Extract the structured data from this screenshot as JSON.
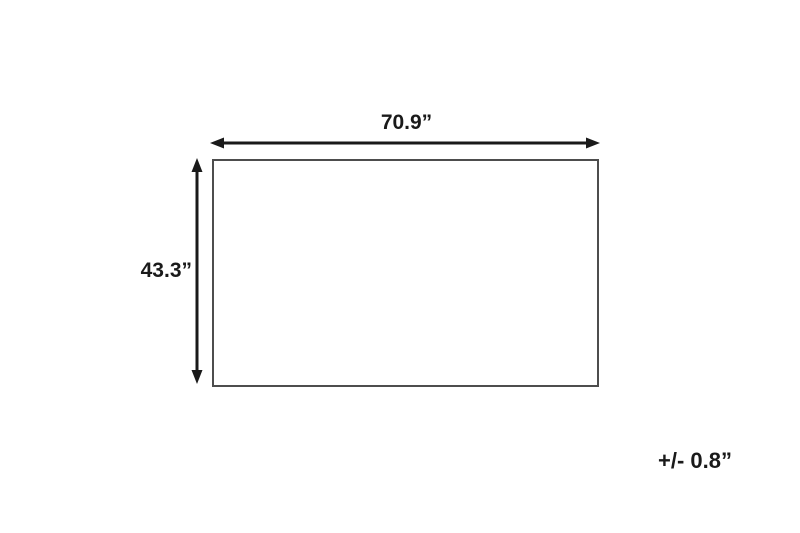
{
  "diagram": {
    "type": "product-dimension-diagram",
    "shape": "rectangle",
    "width_label": "70.9”",
    "height_label": "43.3”",
    "tolerance_label": "+/- 0.8”",
    "colors": {
      "background": "#ffffff",
      "rectangle_outline": "#4d4d4d",
      "arrow": "#1a1a1a",
      "text": "#1a1a1a"
    }
  }
}
